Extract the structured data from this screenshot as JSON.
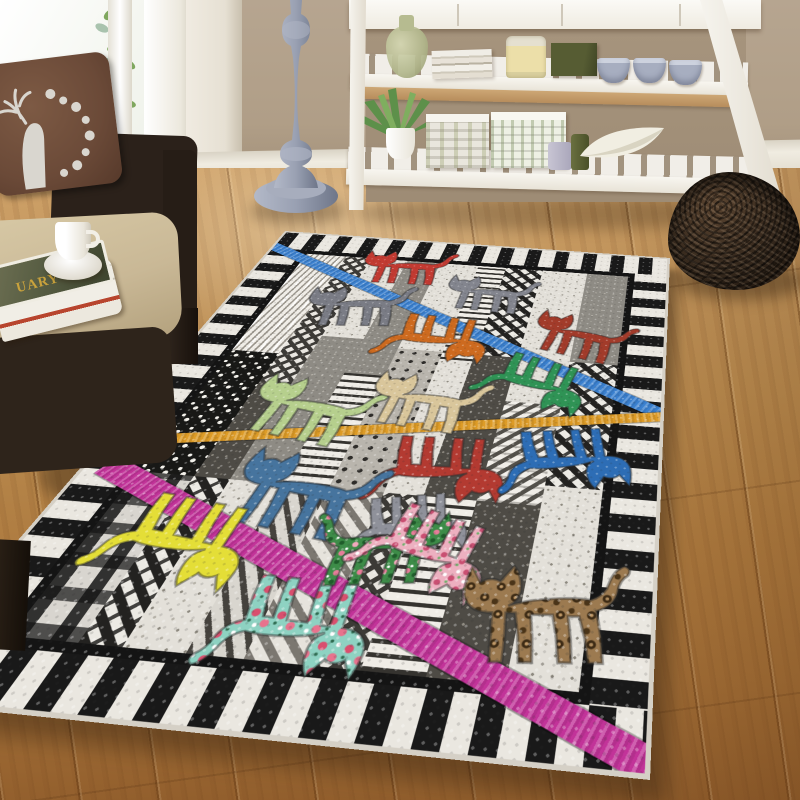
{
  "scene": {
    "description": "Living room photo: patchwork cat area rug on oak floor, wicker armchair with deer pillow, white ladder shelf console, gray pedestal table, woven twig basket",
    "window": {
      "frame_color": "#f3f1ea",
      "glass_color": "#f6f7f2",
      "plant": "hanging green vine"
    },
    "wall": {
      "color": "#b2a18b",
      "white_band_color": "#f0ebe1",
      "baseboard_color": "#efebe0"
    },
    "floor": {
      "material": "oak planks",
      "light_color": "#cfa269",
      "dark_color": "#8f5c2b"
    },
    "armchair": {
      "frame_color": "#2b211a",
      "cushion_color": "#c9b896"
    },
    "pillow": {
      "base_color": "#6b4a38",
      "print_color": "#d9d6cf",
      "motif": "deer head with floral wreath"
    },
    "magazines": {
      "visible_text": "UARY",
      "text_color": "#c9a23c",
      "cover_color": "#565c42"
    },
    "coffee_cup": {
      "color": "#ffffff"
    },
    "pedestal_table": {
      "color": "#98a0b2"
    },
    "shelf_unit": {
      "color": "#f3f0e9",
      "shelf_wood_color": "#c49a68",
      "top_shelf_items": [
        "green glass jug",
        "stack of books",
        "candle jar",
        "green box",
        "ceramic cup",
        "ceramic cup",
        "ceramic cup"
      ],
      "bottom_shelf_items": [
        "potted aloe plant",
        "patterned storage box",
        "patterned storage box",
        "small candle",
        "green jar",
        "white leaf bowl"
      ]
    },
    "basket": {
      "color": "#32261b",
      "material": "woven twig"
    }
  },
  "rug": {
    "style": "patchwork quilt cats area rug",
    "background": "#e9e6df",
    "border": {
      "stripe_dark": "#191919",
      "stripe_light": "#eae7e0",
      "frame_color": "#141414"
    },
    "bands": [
      {
        "name": "blue",
        "color": "#3a80cf",
        "x": -4,
        "y": 22,
        "length": 500,
        "height": 14,
        "angle": 26.7
      },
      {
        "name": "orange",
        "color": "#dd9b26",
        "x": 42,
        "y": 318,
        "length": 404,
        "height": 11,
        "angle": -10.2
      },
      {
        "name": "magenta",
        "color": "#c23399",
        "x": 14,
        "y": 344,
        "length": 466,
        "height": 20,
        "angle": 22.6
      }
    ],
    "columns": [
      {
        "w": 44,
        "patches": [
          {
            "h": 170,
            "p": "herr"
          },
          {
            "h": 150,
            "p": "daisy"
          },
          {
            "h": 136,
            "p": "plaid"
          }
        ]
      },
      {
        "w": 28,
        "patches": [
          {
            "h": 210,
            "p": "zig"
          },
          {
            "h": 110,
            "p": "speckd"
          },
          {
            "h": 136,
            "p": "hound"
          }
        ]
      },
      {
        "w": 40,
        "patches": [
          {
            "h": 140,
            "p": "speckl"
          },
          {
            "h": 180,
            "p": "gray"
          },
          {
            "h": 136,
            "p": "speckl"
          }
        ]
      },
      {
        "w": 36,
        "patches": [
          {
            "h": 190,
            "p": "gray"
          },
          {
            "h": 130,
            "p": "wave"
          },
          {
            "h": 136,
            "p": "diag"
          }
        ]
      },
      {
        "w": 42,
        "patches": [
          {
            "h": 150,
            "p": "speckl"
          },
          {
            "h": 170,
            "p": "dots"
          },
          {
            "h": 136,
            "p": "chevron"
          }
        ]
      },
      {
        "w": 30,
        "patches": [
          {
            "h": 160,
            "p": "wave"
          },
          {
            "h": 160,
            "p": "speckl"
          },
          {
            "h": 136,
            "p": "zig"
          }
        ]
      },
      {
        "w": 40,
        "patches": [
          {
            "h": 150,
            "p": "hound"
          },
          {
            "h": 170,
            "p": "speckd"
          },
          {
            "h": 136,
            "p": "wave"
          }
        ]
      },
      {
        "w": 48,
        "patches": [
          {
            "h": 210,
            "p": "speckl"
          },
          {
            "h": 110,
            "p": "tri"
          },
          {
            "h": 136,
            "p": "speckd"
          }
        ]
      },
      {
        "w": 48,
        "patches": [
          {
            "h": 150,
            "p": "gray"
          },
          {
            "h": 150,
            "p": "hound"
          },
          {
            "h": 156,
            "p": "speckl"
          }
        ]
      }
    ],
    "cats": [
      {
        "name": "red",
        "x": 150,
        "y": 54,
        "rot": -2,
        "scale": 0.92,
        "flip": false,
        "fill": "#c23a31"
      },
      {
        "name": "gray",
        "x": 250,
        "y": 92,
        "rot": 3,
        "scale": 0.88,
        "flip": false,
        "fill": "#83858e"
      },
      {
        "name": "brick",
        "x": 352,
        "y": 151,
        "rot": 14,
        "scale": 0.92,
        "flip": false,
        "fill": "#a23b2a"
      },
      {
        "name": "slate-gray",
        "x": 123,
        "y": 130,
        "rot": -6,
        "scale": 0.98,
        "flip": false,
        "fill": "#7a7c85"
      },
      {
        "name": "orange",
        "x": 230,
        "y": 173,
        "rot": 183,
        "scale": 0.98,
        "flip": false,
        "fill": "#cd6a1f"
      },
      {
        "name": "green",
        "x": 334,
        "y": 227,
        "rot": 196,
        "scale": 0.92,
        "flip": false,
        "fill": "#2f9355"
      },
      {
        "name": "pale-green",
        "x": 134,
        "y": 279,
        "rot": 10,
        "scale": 1.02,
        "flip": false,
        "fill": "#b6cf8d"
      },
      {
        "name": "tan",
        "x": 229,
        "y": 259,
        "rot": 6,
        "scale": 0.95,
        "flip": false,
        "fill": "#d9c69b"
      },
      {
        "name": "red-flipped",
        "x": 277,
        "y": 335,
        "rot": 177,
        "scale": 0.98,
        "flip": false,
        "fill": "#b33a31"
      },
      {
        "name": "blue",
        "x": 374,
        "y": 313,
        "rot": 170,
        "scale": 0.95,
        "flip": false,
        "fill": "#2d6db5"
      },
      {
        "name": "steel-blue",
        "x": 165,
        "y": 367,
        "rot": 8,
        "scale": 1.05,
        "flip": false,
        "fill": "#46749e"
      },
      {
        "name": "yellow",
        "x": 114,
        "y": 421,
        "rot": 187,
        "scale": 1.0,
        "flip": false,
        "fill": "#e4de37"
      },
      {
        "name": "gray-small",
        "x": 268,
        "y": 389,
        "rot": 168,
        "scale": 0.78,
        "flip": false,
        "fill": "#8f919a"
      },
      {
        "name": "mint-floral",
        "x": 220,
        "y": 475,
        "rot": 181,
        "scale": 0.95,
        "flip": false,
        "fill": "pattern:patMint"
      },
      {
        "name": "green-floral",
        "x": 255,
        "y": 409,
        "rot": -8,
        "scale": 0.88,
        "flip": true,
        "fill": "pattern:patGreenFloral"
      },
      {
        "name": "pink-floral",
        "x": 288,
        "y": 412,
        "rot": 197,
        "scale": 0.9,
        "flip": false,
        "fill": "pattern:patPink"
      },
      {
        "name": "leopard",
        "x": 361,
        "y": 449,
        "rot": -5,
        "scale": 1.02,
        "flip": false,
        "fill": "pattern:patLeopard"
      }
    ]
  }
}
